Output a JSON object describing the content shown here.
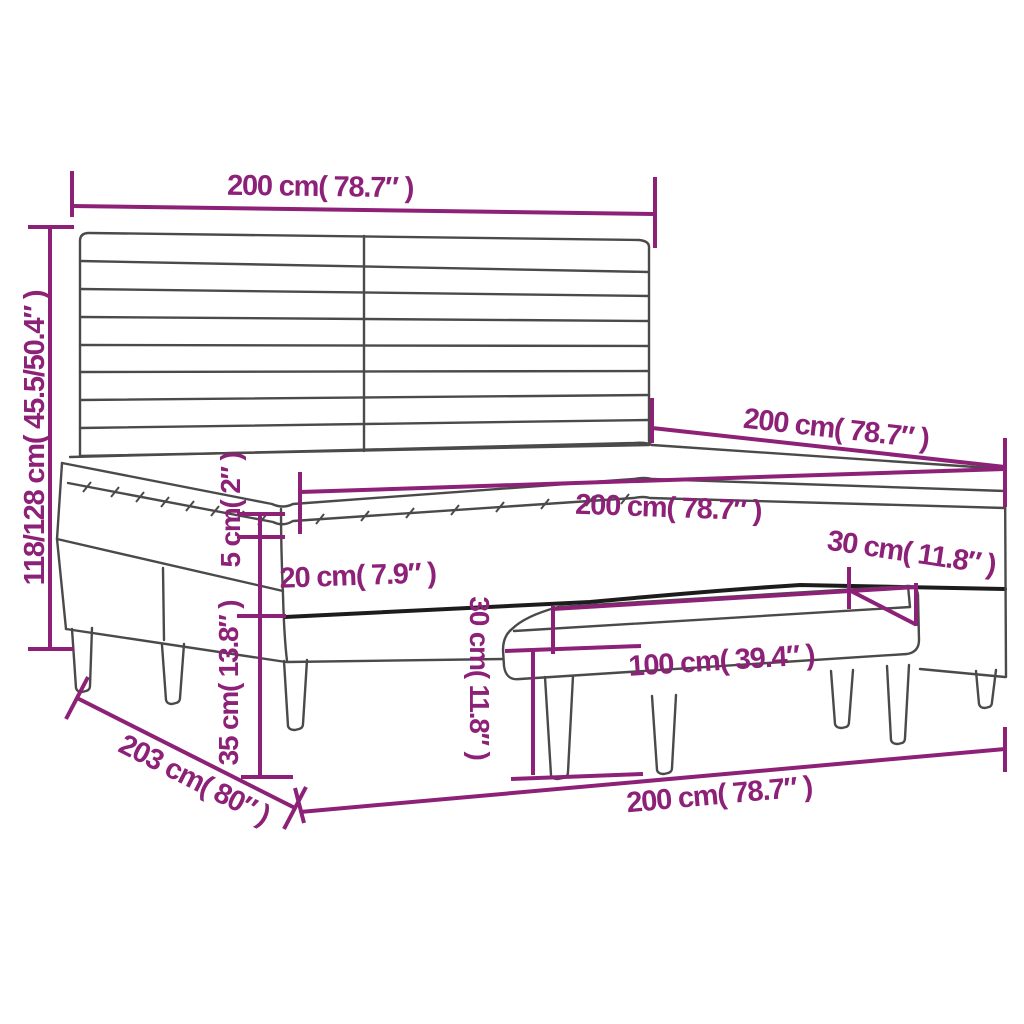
{
  "diagram": {
    "kind": "product-dimension-diagram",
    "product": "box spring bed with slatted headboard, mattress topper and bench",
    "background_color": "#ffffff",
    "dimension_color": "#8c2177",
    "outline_color": "#4a4a4a",
    "dimensions": {
      "headboard_width": {
        "label": "200 cm( 78.7″ )"
      },
      "overall_height": {
        "label": "118/128 cm( 45.5/50.4″ )"
      },
      "bed_length": {
        "label": "200 cm( 78.7″ )"
      },
      "mattress_width": {
        "label": "200 cm( 78.7″ )"
      },
      "topper_thickness": {
        "label": "5 cm( 2″ )"
      },
      "mattress_thickness": {
        "label": "20 cm( 7.9″ )"
      },
      "base_and_leg_height": {
        "label": "35 cm( 13.8″ )"
      },
      "bench_height": {
        "label": "30 cm( 11.8″ )"
      },
      "base_height": {
        "label": "30 cm( 11.8″ )"
      },
      "bench_length": {
        "label": "100 cm( 39.4″ )"
      },
      "bed_depth": {
        "label": "203 cm( 80″ )"
      },
      "bed_width": {
        "label": "200 cm( 78.7″ )"
      }
    }
  }
}
